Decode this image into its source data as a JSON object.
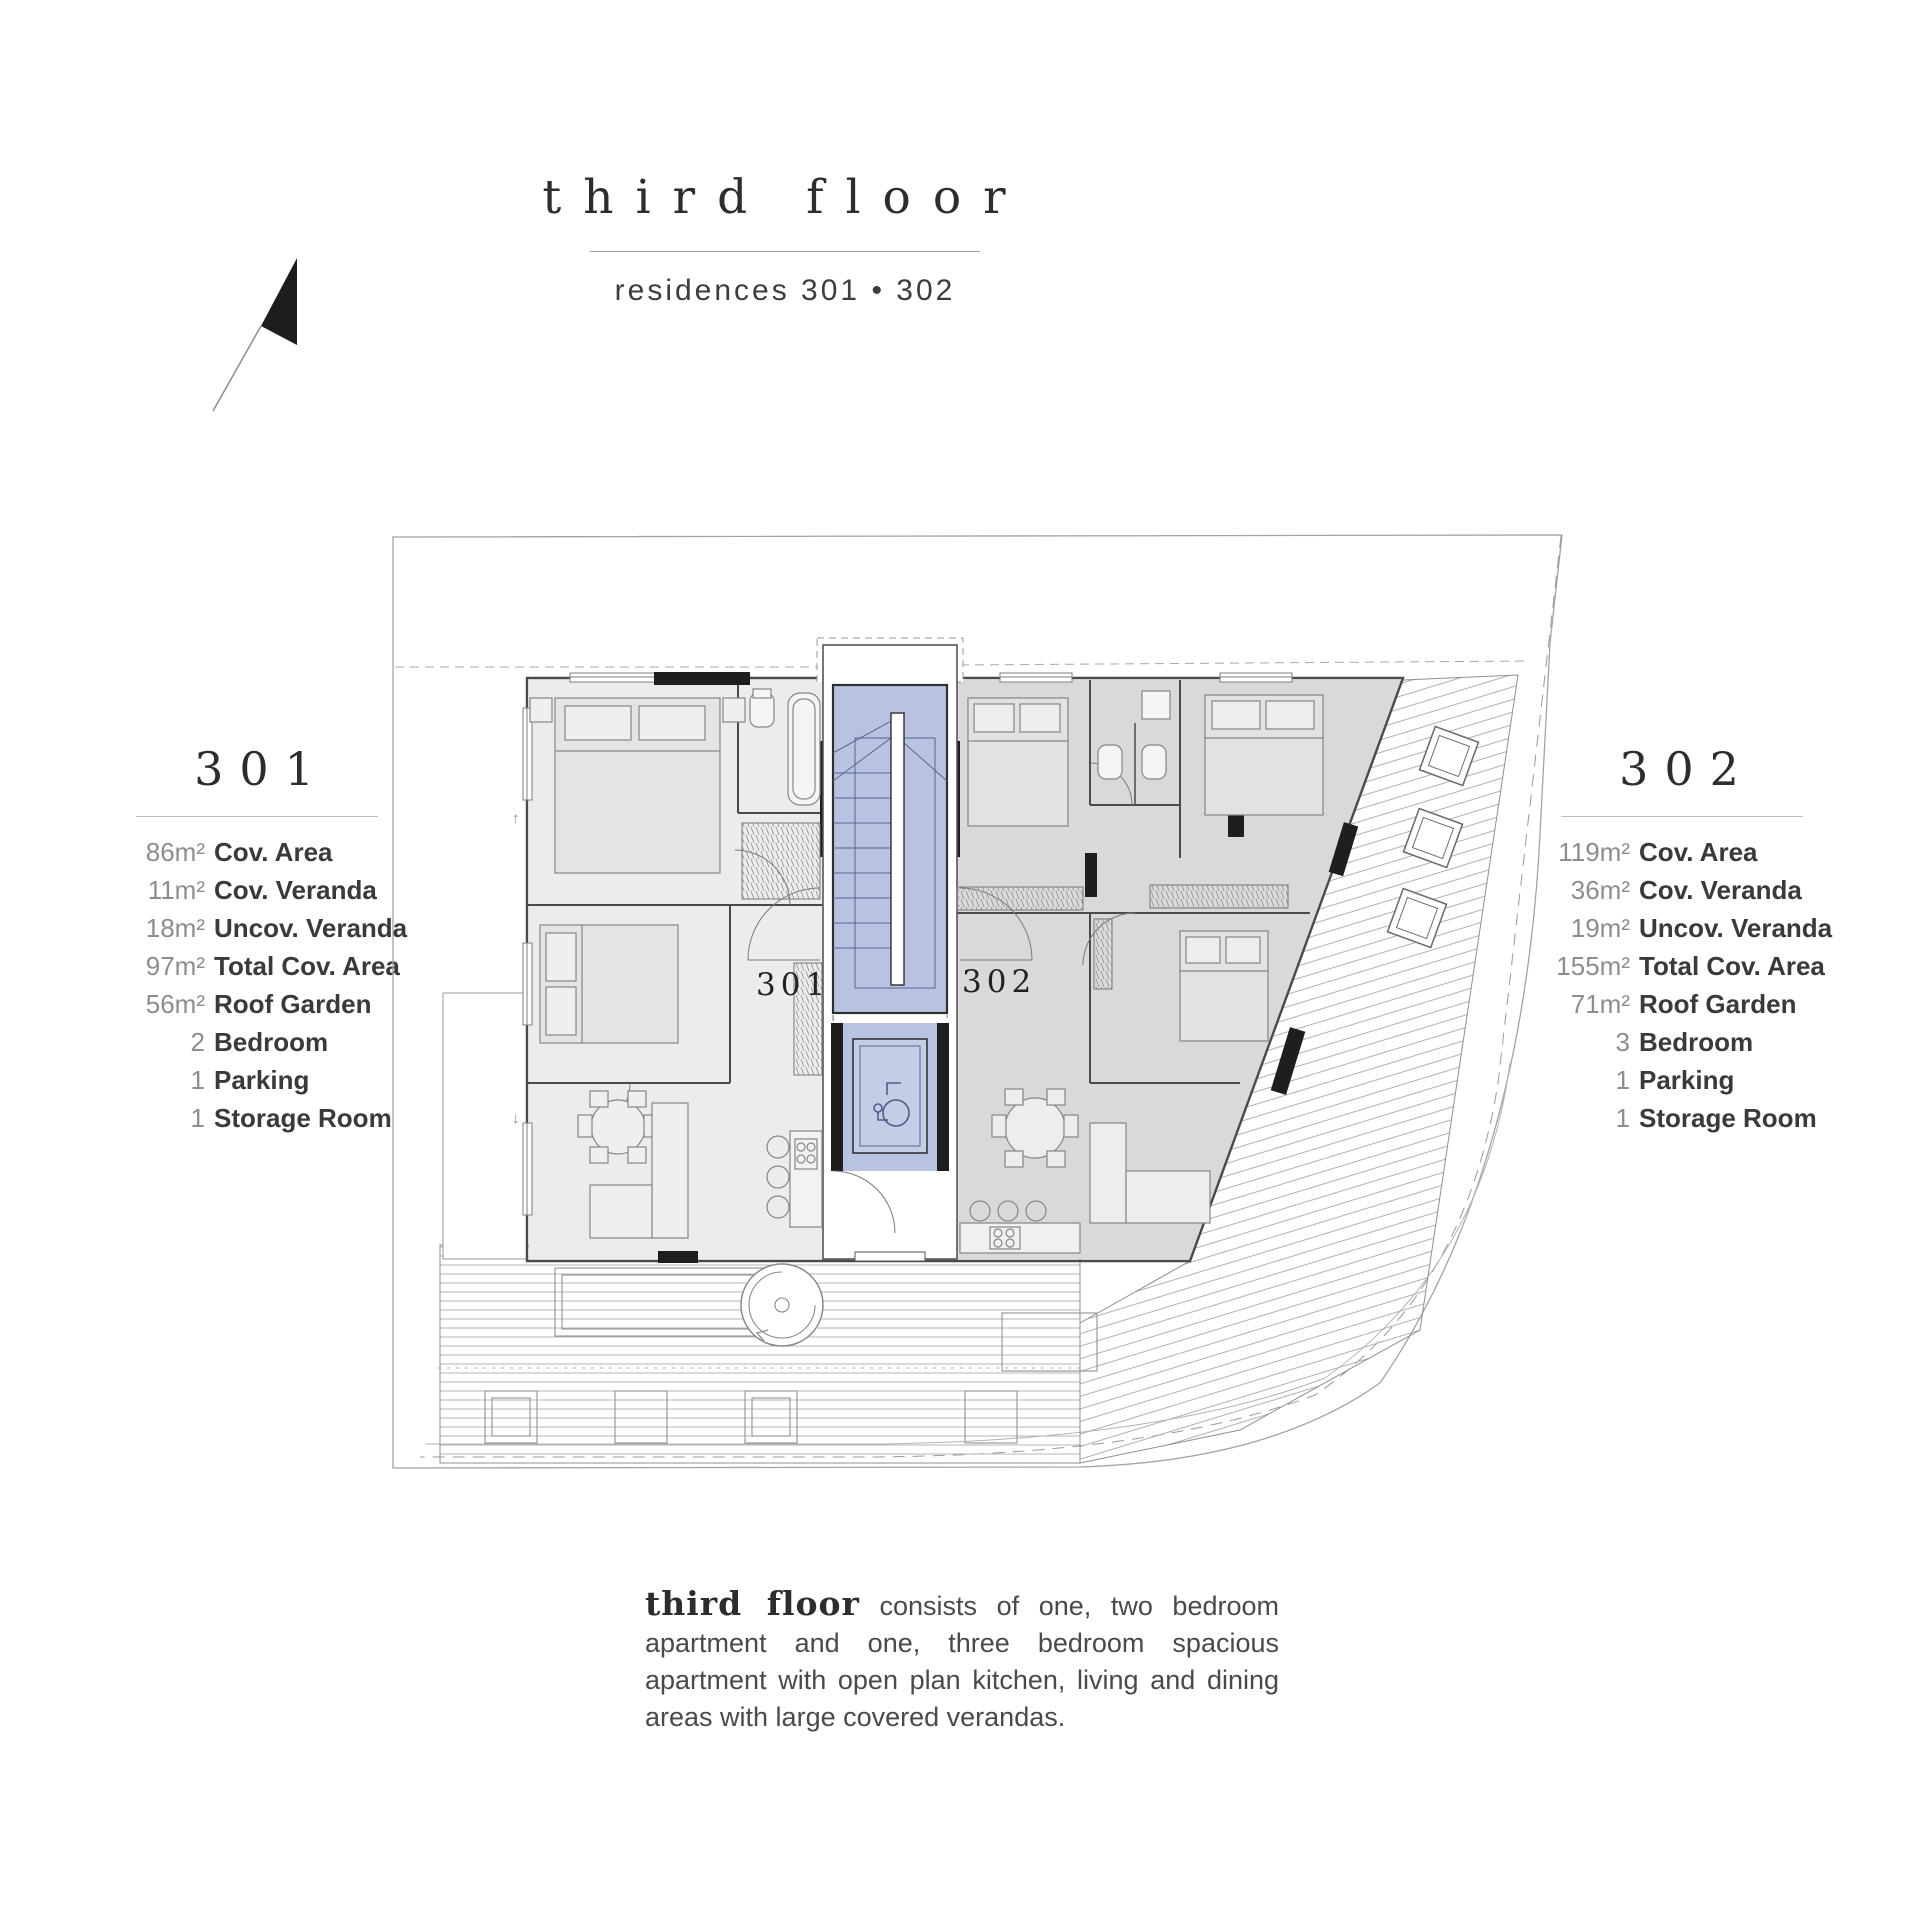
{
  "header": {
    "title": "third floor",
    "subtitle": "residences  301 • 302"
  },
  "compass": {
    "icon": "north-arrow"
  },
  "unit_panels": [
    {
      "id": "301",
      "title": "301",
      "specs": [
        {
          "value": "86m²",
          "label": "Cov. Area"
        },
        {
          "value": "11m²",
          "label": "Cov. Veranda"
        },
        {
          "value": "18m²",
          "label": "Uncov. Veranda"
        },
        {
          "value": "97m²",
          "label": "Total Cov. Area"
        },
        {
          "value": "56m²",
          "label": "Roof Garden"
        },
        {
          "value": "2",
          "label": "Bedroom"
        },
        {
          "value": "1",
          "label": "Parking"
        },
        {
          "value": "1",
          "label": "Storage Room"
        }
      ]
    },
    {
      "id": "302",
      "title": "302",
      "specs": [
        {
          "value": "119m²",
          "label": "Cov. Area"
        },
        {
          "value": "36m²",
          "label": "Cov. Veranda"
        },
        {
          "value": "19m²",
          "label": "Uncov. Veranda"
        },
        {
          "value": "155m²",
          "label": "Total Cov. Area"
        },
        {
          "value": "71m²",
          "label": "Roof Garden"
        },
        {
          "value": "3",
          "label": "Bedroom"
        },
        {
          "value": "1",
          "label": "Parking"
        },
        {
          "value": "1",
          "label": "Storage Room"
        }
      ]
    }
  ],
  "floor_plan": {
    "unit_labels": [
      "301",
      "302"
    ],
    "colors": {
      "core_highlight": "#b7c3e1",
      "unit301_fill": "#ececec",
      "unit302_fill": "#d9d9d9",
      "wall": "#4a4a4a",
      "boundary": "#a3a3a3"
    }
  },
  "description": {
    "lead": "third floor",
    "body": " consists of one, two bedroom apartment and one, three bedroom spacious apartment with open plan kitchen, living and dining areas with large covered verandas."
  }
}
